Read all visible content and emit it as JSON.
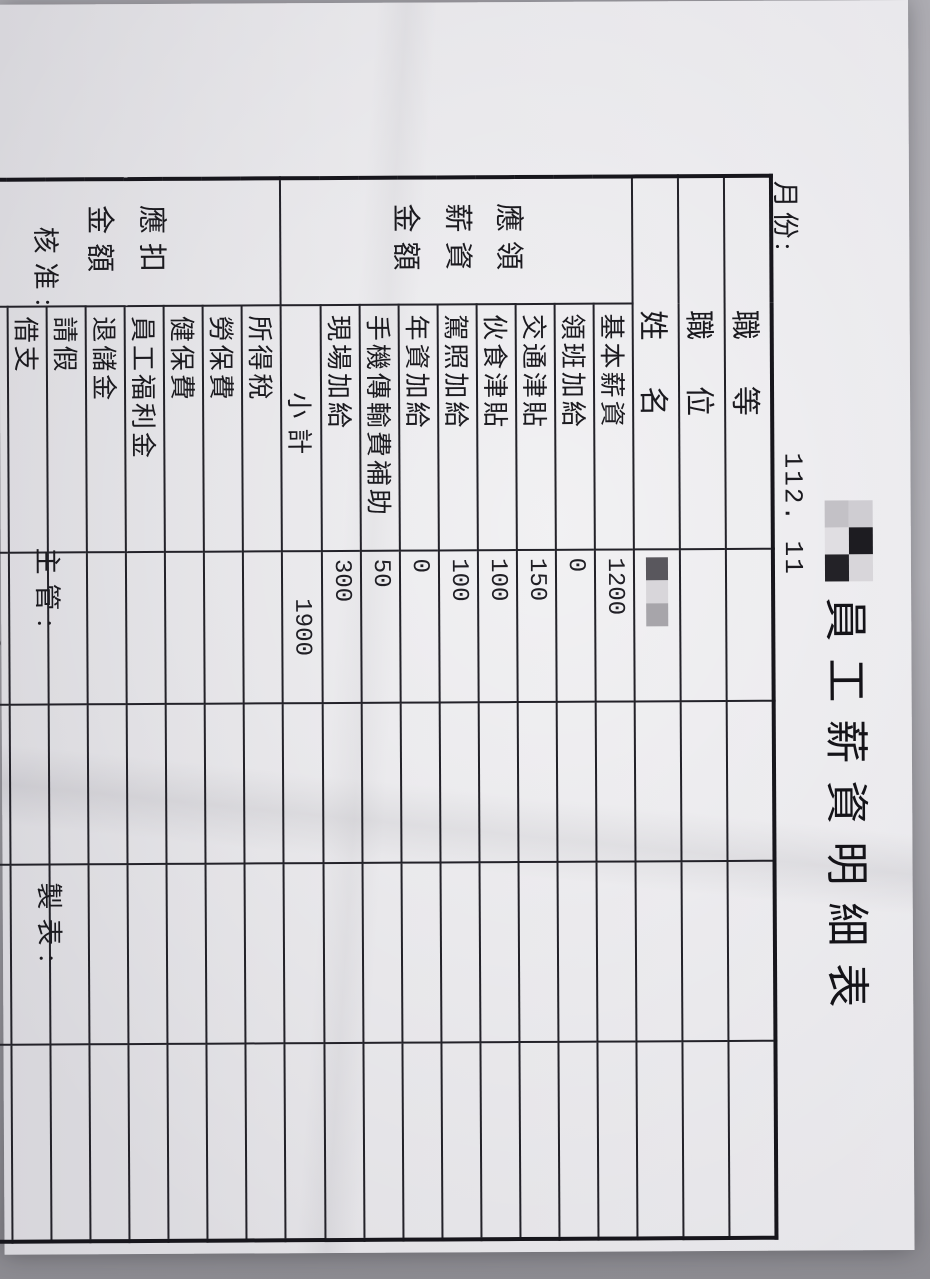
{
  "document": {
    "title": "員工薪資明細表",
    "month_label": "月份:",
    "month_value": "112. 11",
    "footer": {
      "approved_by": "核准:",
      "supervisor": "主管:",
      "prepared_by": "製表:"
    }
  },
  "table": {
    "header_rows": [
      {
        "label": "職等",
        "value": ""
      },
      {
        "label": "職位",
        "value": ""
      },
      {
        "label": "姓名",
        "value": ""
      }
    ],
    "earnings": {
      "group_label": "應領薪資金額",
      "rows": [
        {
          "label": "基本薪資",
          "value": "1200"
        },
        {
          "label": "領班加給",
          "value": "0"
        },
        {
          "label": "交通津貼",
          "value": "150"
        },
        {
          "label": "伙食津貼",
          "value": "100"
        },
        {
          "label": "駕照加給",
          "value": "100"
        },
        {
          "label": "年資加給",
          "value": "0"
        },
        {
          "label": "手機傳輸費補助",
          "value": "50"
        },
        {
          "label": "現場加給",
          "value": "300"
        }
      ],
      "subtotal": {
        "label": "小計",
        "value": "1900"
      }
    },
    "deductions": {
      "group_label": "應扣金額",
      "rows": [
        {
          "label": "所得稅",
          "value": ""
        },
        {
          "label": "勞保費",
          "value": ""
        },
        {
          "label": "健保費",
          "value": ""
        },
        {
          "label": "員工福利金",
          "value": ""
        },
        {
          "label": "退儲金",
          "value": ""
        },
        {
          "label": "請假",
          "value": ""
        },
        {
          "label": "借支",
          "value": ""
        }
      ],
      "total": {
        "label": "合計",
        "value": "· 0"
      }
    },
    "summary_rows": [
      {
        "label": "實領金額",
        "value": "1900"
      },
      {
        "label": "誤餐補助",
        "value": ""
      },
      {
        "label": "加班費",
        "value": ""
      }
    ],
    "grand_total": {
      "label": "總計",
      "value": "1900"
    }
  },
  "colors": {
    "ink": "#1b1a1f",
    "paper": "#e2e1e5",
    "background": "#a9a8ae"
  }
}
